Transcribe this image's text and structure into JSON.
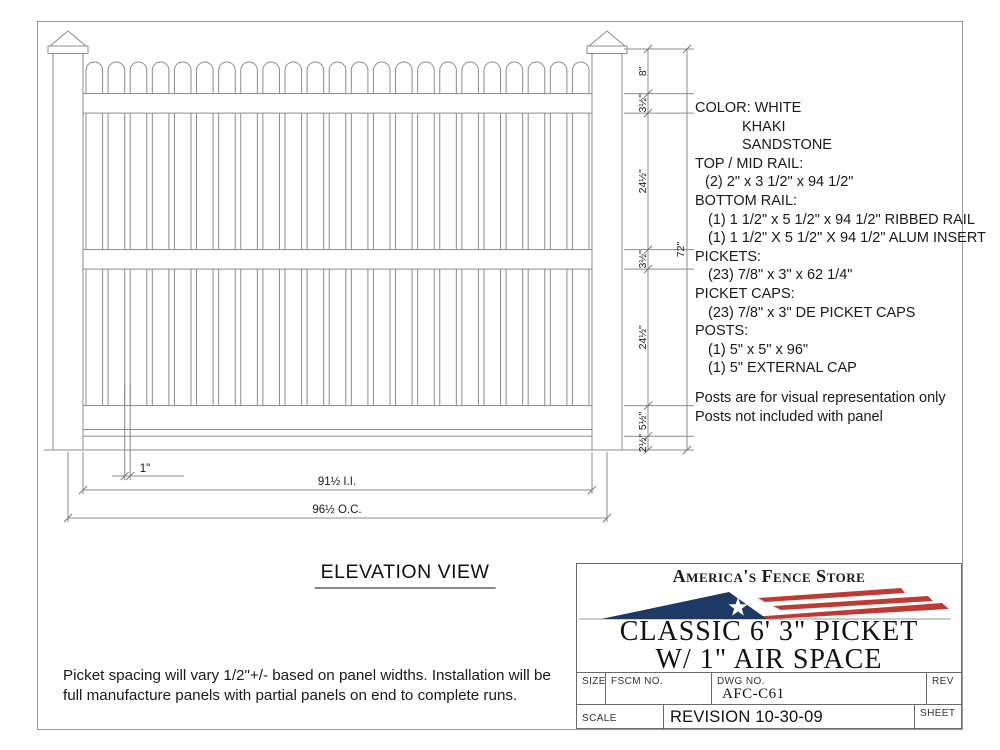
{
  "colors": {
    "navy": "#1e3a64",
    "red": "#bf3a33",
    "line": "#8c8c8c",
    "ink": "#1a1a1a"
  },
  "drawing": {
    "elevation_label": "ELEVATION VIEW",
    "picket_count": 23,
    "right_dims": [
      "8\"",
      "3½\"",
      "24½\"",
      "3½\"",
      "24½\"",
      "5½\"",
      "2½\""
    ],
    "overall_height": "72\"",
    "picket_space": "1\"",
    "inside_dim": "91½ I.I.",
    "oc_dim": "96½ O.C."
  },
  "spec": {
    "lines": [
      {
        "text": "COLOR: WHITE",
        "indent": 0
      },
      {
        "text": "KHAKI",
        "indent": 47
      },
      {
        "text": "SANDSTONE",
        "indent": 47
      },
      {
        "text": "TOP / MID RAIL:",
        "indent": 0
      },
      {
        "text": "(2) 2\"  x 3 1/2\" x 94 1/2\"",
        "indent": 10
      },
      {
        "text": "BOTTOM RAIL:",
        "indent": 0
      },
      {
        "text": "(1) 1 1/2\" x 5 1/2\" x 94 1/2\" RIBBED RAIL",
        "indent": 13
      },
      {
        "text": "(1) 1 1/2\" X 5 1/2\" X 94 1/2\" ALUM INSERT",
        "indent": 13
      },
      {
        "text": "PICKETS:",
        "indent": 0
      },
      {
        "text": "(23) 7/8\" x 3\" x 62 1/4\"",
        "indent": 13
      },
      {
        "text": "PICKET CAPS:",
        "indent": 0
      },
      {
        "text": "(23) 7/8\" x 3\" DE PICKET CAPS",
        "indent": 13
      },
      {
        "text": "POSTS:",
        "indent": 0
      },
      {
        "text": "(1) 5\" x 5\" x 96\"",
        "indent": 13
      },
      {
        "text": "(1) 5\" EXTERNAL CAP",
        "indent": 13
      }
    ],
    "notes": [
      "Posts are for visual representation only",
      "Posts not included with panel"
    ]
  },
  "footnote": {
    "line1": "Picket spacing will vary 1/2\"+/- based on panel widths.  Installation will be",
    "line2": "full manufacture panels with partial panels on end to complete runs."
  },
  "title_block": {
    "brand": "America's Fence Store",
    "title_line1": "CLASSIC 6' 3\" PICKET",
    "title_line2": "W/ 1\" AIR SPACE",
    "size_label": "SIZE",
    "fscm_label": "FSCM NO.",
    "dwg_label": "DWG NO.",
    "dwg_no": "AFC-C61",
    "rev_label": "REV",
    "scale_label": "SCALE",
    "revision": "REVISION 10-30-09",
    "sheet_label": "SHEET"
  }
}
